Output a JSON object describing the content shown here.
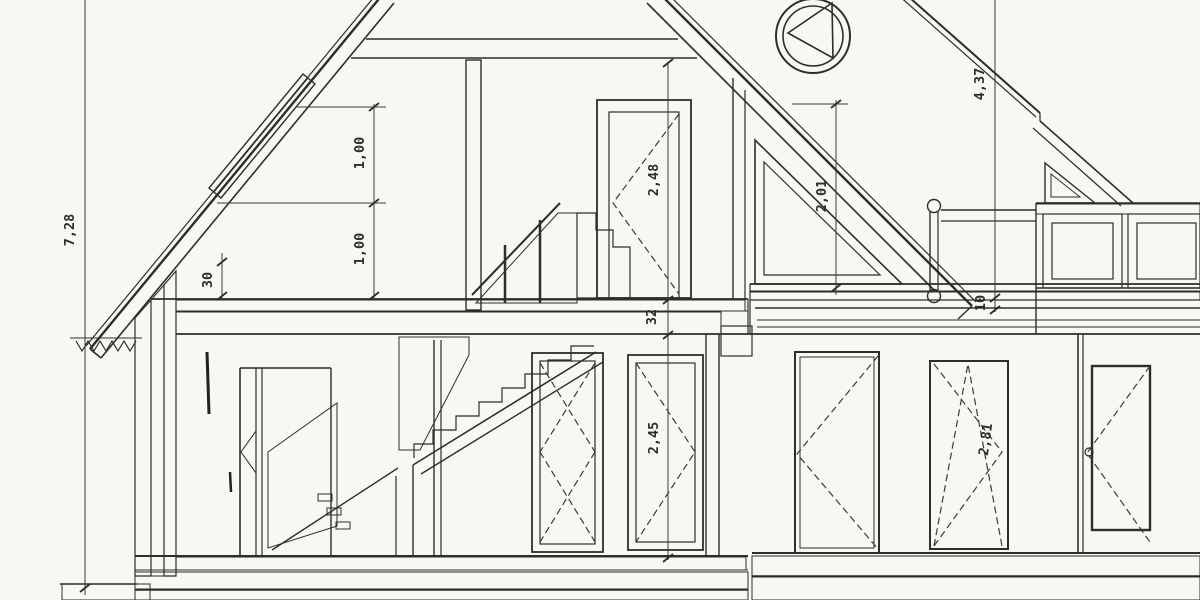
{
  "drawing": {
    "type": "architectural-section",
    "ink": "#2e2d2b",
    "paper": "#f8f7f3",
    "dims": {
      "total_height": "7,28",
      "skylight_top": "1,00",
      "skylight_bottom": "1,00",
      "knee_wall": "30",
      "attic_room_height": "2,48",
      "slab_thickness": "32",
      "gable_window_height": "2,01",
      "ridge_height": "4,37",
      "balcony_step": "10",
      "ground_room_height": "2,45",
      "annex_room_height": "2,81"
    }
  }
}
